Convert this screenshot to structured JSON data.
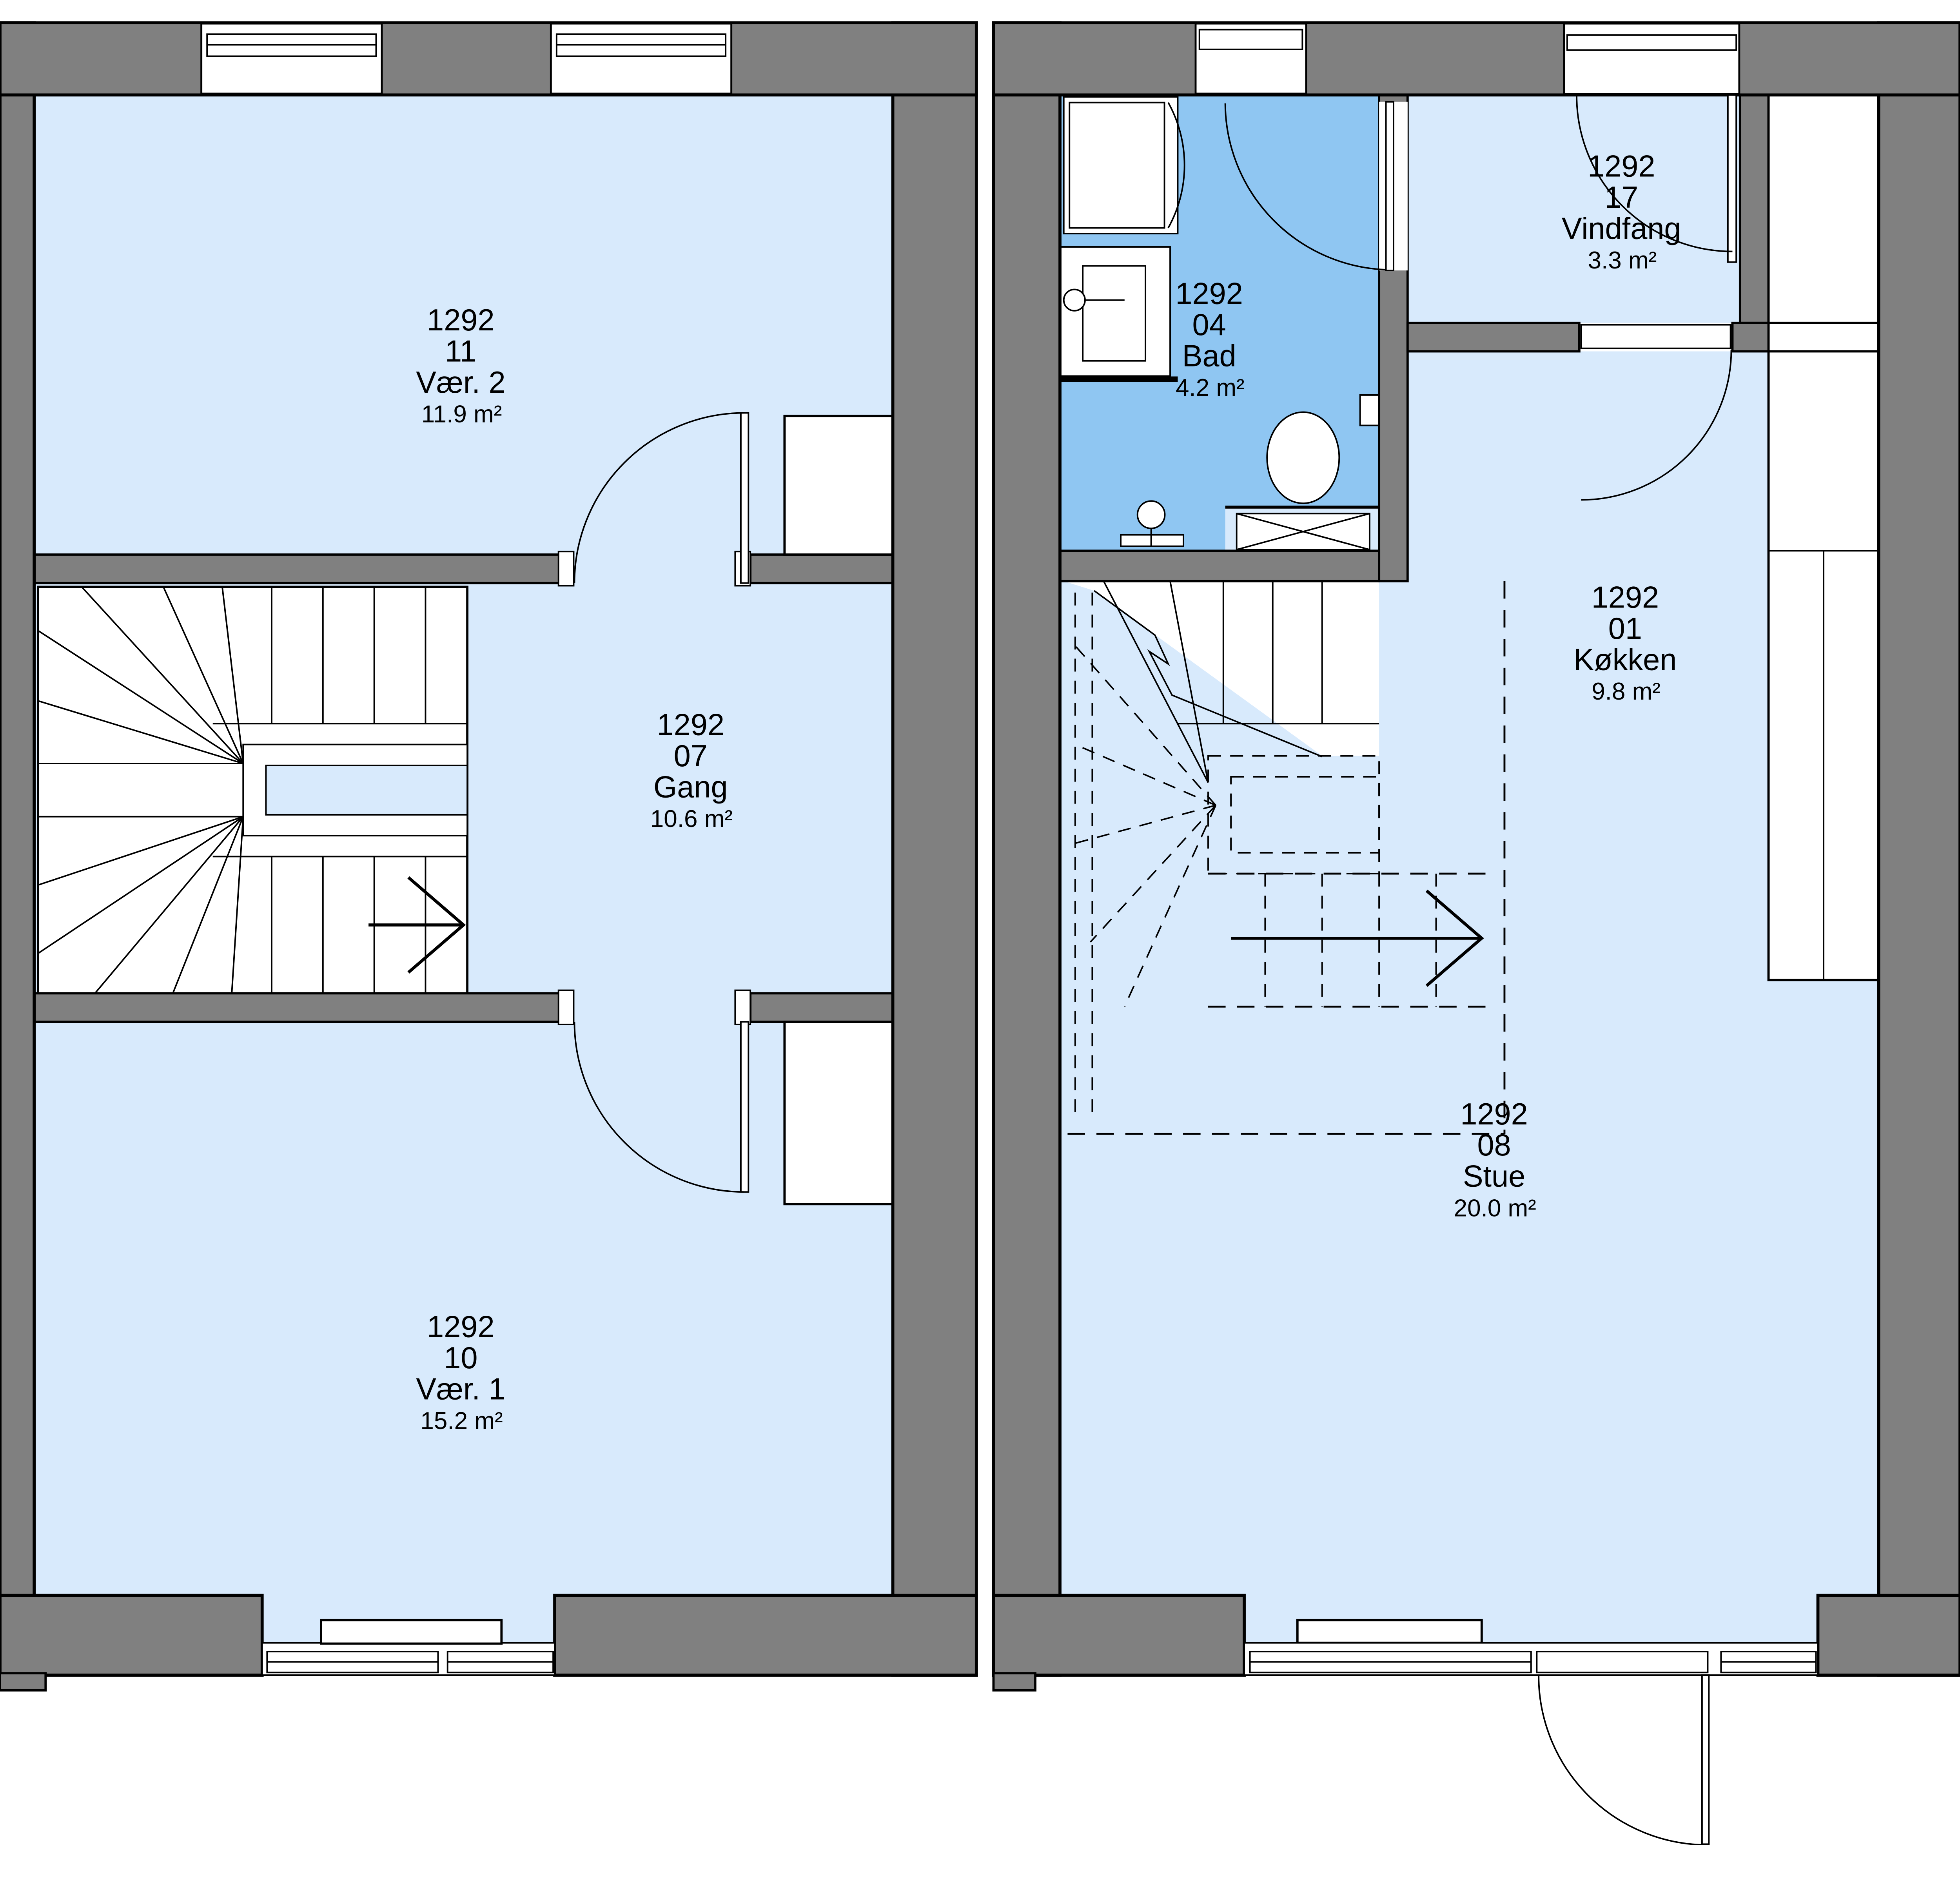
{
  "drawing": {
    "type": "architectural floor plan",
    "unit_id": "1292"
  },
  "rooms": {
    "vaer2": {
      "unit": "1292",
      "number": "11",
      "name": "Vær. 2",
      "area": "11.9 m²"
    },
    "gang": {
      "unit": "1292",
      "number": "07",
      "name": "Gang",
      "area": "10.6 m²"
    },
    "vaer1": {
      "unit": "1292",
      "number": "10",
      "name": "Vær. 1",
      "area": "15.2 m²"
    },
    "bad": {
      "unit": "1292",
      "number": "04",
      "name": "Bad",
      "area": "4.2 m²"
    },
    "vindfang": {
      "unit": "1292",
      "number": "17",
      "name": "Vindfang",
      "area": "3.3 m²"
    },
    "koekken": {
      "unit": "1292",
      "number": "01",
      "name": "Køkken",
      "area": "9.8 m²"
    },
    "stue": {
      "unit": "1292",
      "number": "08",
      "name": "Stue",
      "area": "20.0 m²"
    }
  },
  "colors": {
    "wall_fill": "#808080",
    "outline": "#000000",
    "room_fill": "#d8eafc",
    "bathroom_fill": "#8fc6f2",
    "background": "#ffffff"
  }
}
